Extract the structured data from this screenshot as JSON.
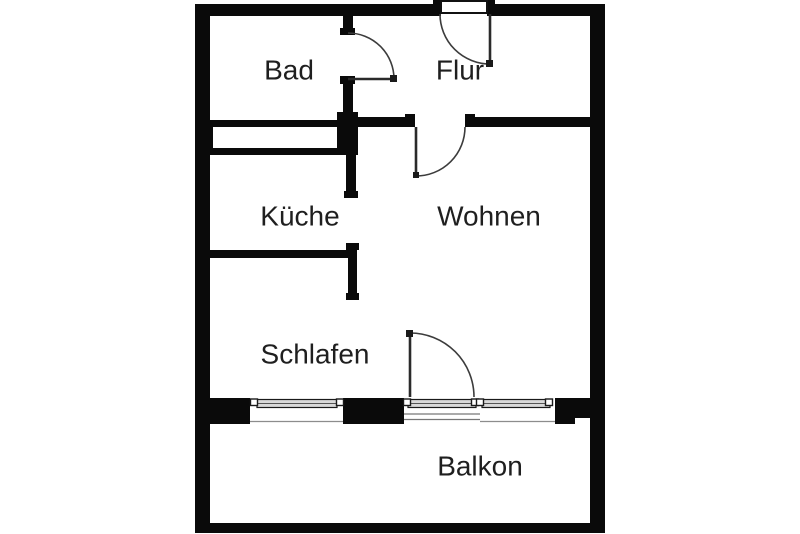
{
  "floorplan": {
    "rooms": [
      {
        "id": "bad",
        "label": "Bad"
      },
      {
        "id": "flur",
        "label": "Flur"
      },
      {
        "id": "kueche",
        "label": "Küche"
      },
      {
        "id": "wohnen",
        "label": "Wohnen"
      },
      {
        "id": "schlafen",
        "label": "Schlafen"
      },
      {
        "id": "balkon",
        "label": "Balkon"
      }
    ],
    "colors": {
      "wall": "#0a0a0a",
      "background": "#ffffff",
      "door_stroke": "#3c3c3c",
      "window_band": "#d9d9d9"
    }
  }
}
